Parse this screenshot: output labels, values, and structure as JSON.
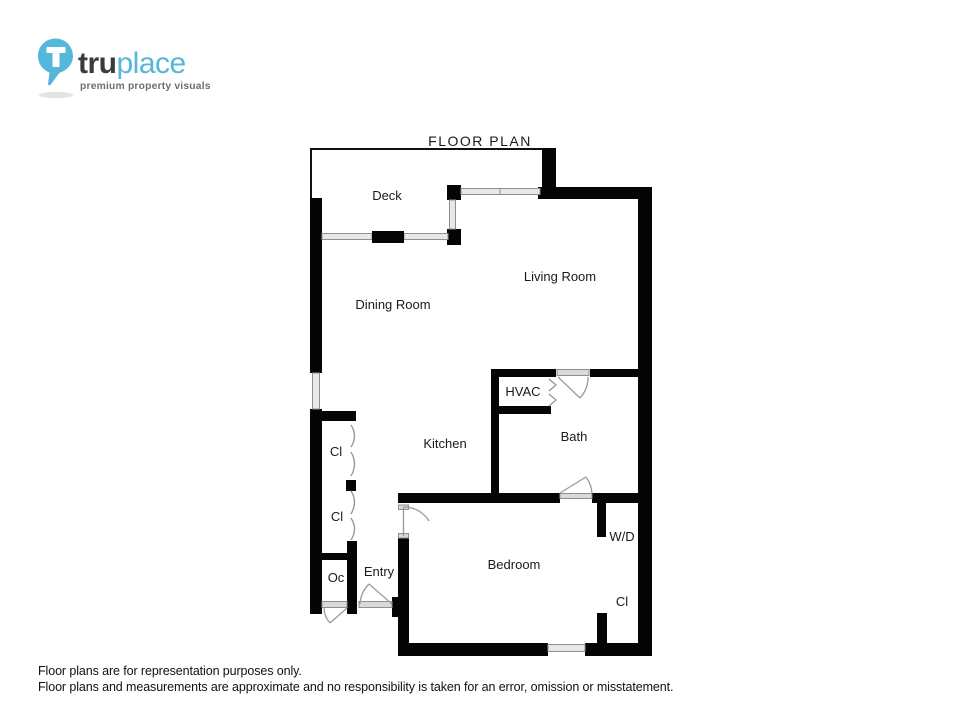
{
  "logo": {
    "brand_primary": "tru",
    "brand_secondary": "place",
    "tagline": "premium property visuals",
    "colors": {
      "accent": "#55b7d9",
      "dark": "#3b3b3d",
      "tagline_gray": "#6d6e70"
    }
  },
  "title": "FLOOR PLAN",
  "floor_plan": {
    "rooms": {
      "deck": "Deck",
      "living_room": "Living Room",
      "dining_room": "Dining Room",
      "kitchen": "Kitchen",
      "hvac": "HVAC",
      "bath": "Bath",
      "bedroom": "Bedroom",
      "entry": "Entry",
      "closet_upper": "Cl",
      "closet_lower": "Cl",
      "closet_bedroom": "Cl",
      "other_closet": "Oc",
      "washer_dryer": "W/D"
    }
  },
  "disclaimer": {
    "line1": "Floor plans are for representation purposes only.",
    "line2": "Floor plans and measurements are approximate and no responsibility is taken for an error, omission or misstatement."
  }
}
